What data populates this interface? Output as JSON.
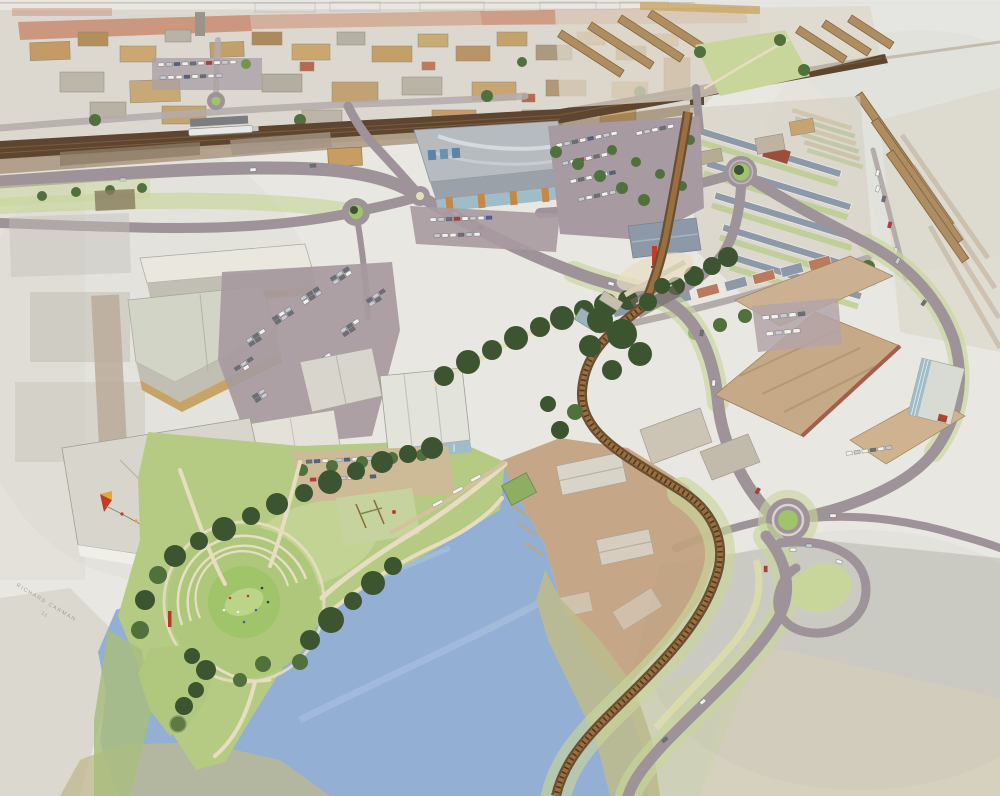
{
  "meta": {
    "title": "Aerial watercolour masterplan illustration",
    "description": "Hand-painted bird's-eye perspective of a riverside regeneration masterplan: an old town and railway across the top, a district centre with a large retail store and car parks, grey industrial warehouses, victorian terraces fanning to the right, a new housing neighbourhood, a curving heritage railway, a brownfield clearance site, and a riverside park with a circular amphitheatre lawn beside a blue river basin; the painting fades to unfinished grey-beige washes at the corners."
  },
  "signature": {
    "text": "RICHARD CARMAN",
    "secondary": "'11"
  },
  "palette": {
    "paper": "#e9e7e1",
    "wash-grey": "#c9c8c1",
    "wash-beige": "#d8d1bd",
    "wash-green": "#ced4ac",
    "town-base": "#dcd8cf",
    "red-roofs": "#c8876a",
    "rail-brown": "#5d4530",
    "rail-light": "#7d5f3e",
    "road": "#9e9399",
    "road-light": "#b4abab",
    "parking": "#a79aa0",
    "path-cream": "#e7ddc1",
    "roof-grey": "#d8d5cc",
    "roof-grey-light": "#e9e7de",
    "roof-grey-dark": "#c1beb4",
    "roof-green-grey": "#d2d4c6",
    "roof-tan": "#c6a987",
    "roof-tan-dark": "#ab8d68",
    "brick": "#a25f4b",
    "retail-roof": "#b6bbc0",
    "retail-roof-dark": "#9aa1a8",
    "glass": "#9fbcc9",
    "orange-wall": "#c58947",
    "roof-slate": "#8d99a9",
    "terrace-roof": "#af8d61",
    "terrace-ridge": "#81653f",
    "lawn": "#b5cb84",
    "lawn-bright": "#9fc46a",
    "lawn-pale": "#c8d69b",
    "park-green": "#aec77b",
    "tree-dark": "#3c5430",
    "tree-mid": "#50703c",
    "tree-light": "#74934f",
    "water": "#93afd3",
    "water-light": "#b7cae3",
    "water-deep": "#7e9bc3",
    "bank-olive": "#bdba8e",
    "site-brown": "#c1a27f",
    "ghost": "#d9d4c8",
    "accent-red": "#c23b28",
    "accent-yellow": "#e2a836",
    "car-white": "#f1f1ee",
    "car-silver": "#c8ccd0",
    "car-dark": "#6a7077",
    "car-red": "#b53a30",
    "car-blue": "#4d628c",
    "ink": "#8f8d80"
  },
  "regions": [
    {
      "id": "old-town-north",
      "label": "Old town with red-tiled terrace band"
    },
    {
      "id": "railway-corridor",
      "label": "Main railway line with station and train"
    },
    {
      "id": "victorian-terraces",
      "label": "Victorian terrace rows fanning to the east, fading to pencil"
    },
    {
      "id": "new-housing",
      "label": "New slate-roofed housing neighbourhood with gardens"
    },
    {
      "id": "retail-store",
      "label": "Large retail store with glass frontage and car park"
    },
    {
      "id": "industrial-west",
      "label": "Grey gabled warehouses and large car park"
    },
    {
      "id": "industrial-east",
      "label": "Tan industrial sheds with brick bases"
    },
    {
      "id": "boulevard",
      "label": "Tree-lined pedestrian boulevard to landmark tower plaza"
    },
    {
      "id": "heritage-railway",
      "label": "Curving single-track railway through the site"
    },
    {
      "id": "brownfield-site",
      "label": "Brown cleared site with ghosted sheds and piers"
    },
    {
      "id": "riverside-park",
      "label": "Riverside park with circular amphitheatre lawn, playground and peninsula point"
    },
    {
      "id": "river-basin",
      "label": "Blue river basin with quay and moorings"
    },
    {
      "id": "roundabouts",
      "label": "Green-centred roundabouts linking the road network"
    },
    {
      "id": "southeast-road",
      "label": "New link road beside the railway with teardrop island"
    },
    {
      "id": "wash-margins",
      "label": "Unpainted watercolour wash margins at the edges"
    },
    {
      "id": "artist-signature",
      "label": "Faint handwritten artist signature, lower left"
    }
  ]
}
